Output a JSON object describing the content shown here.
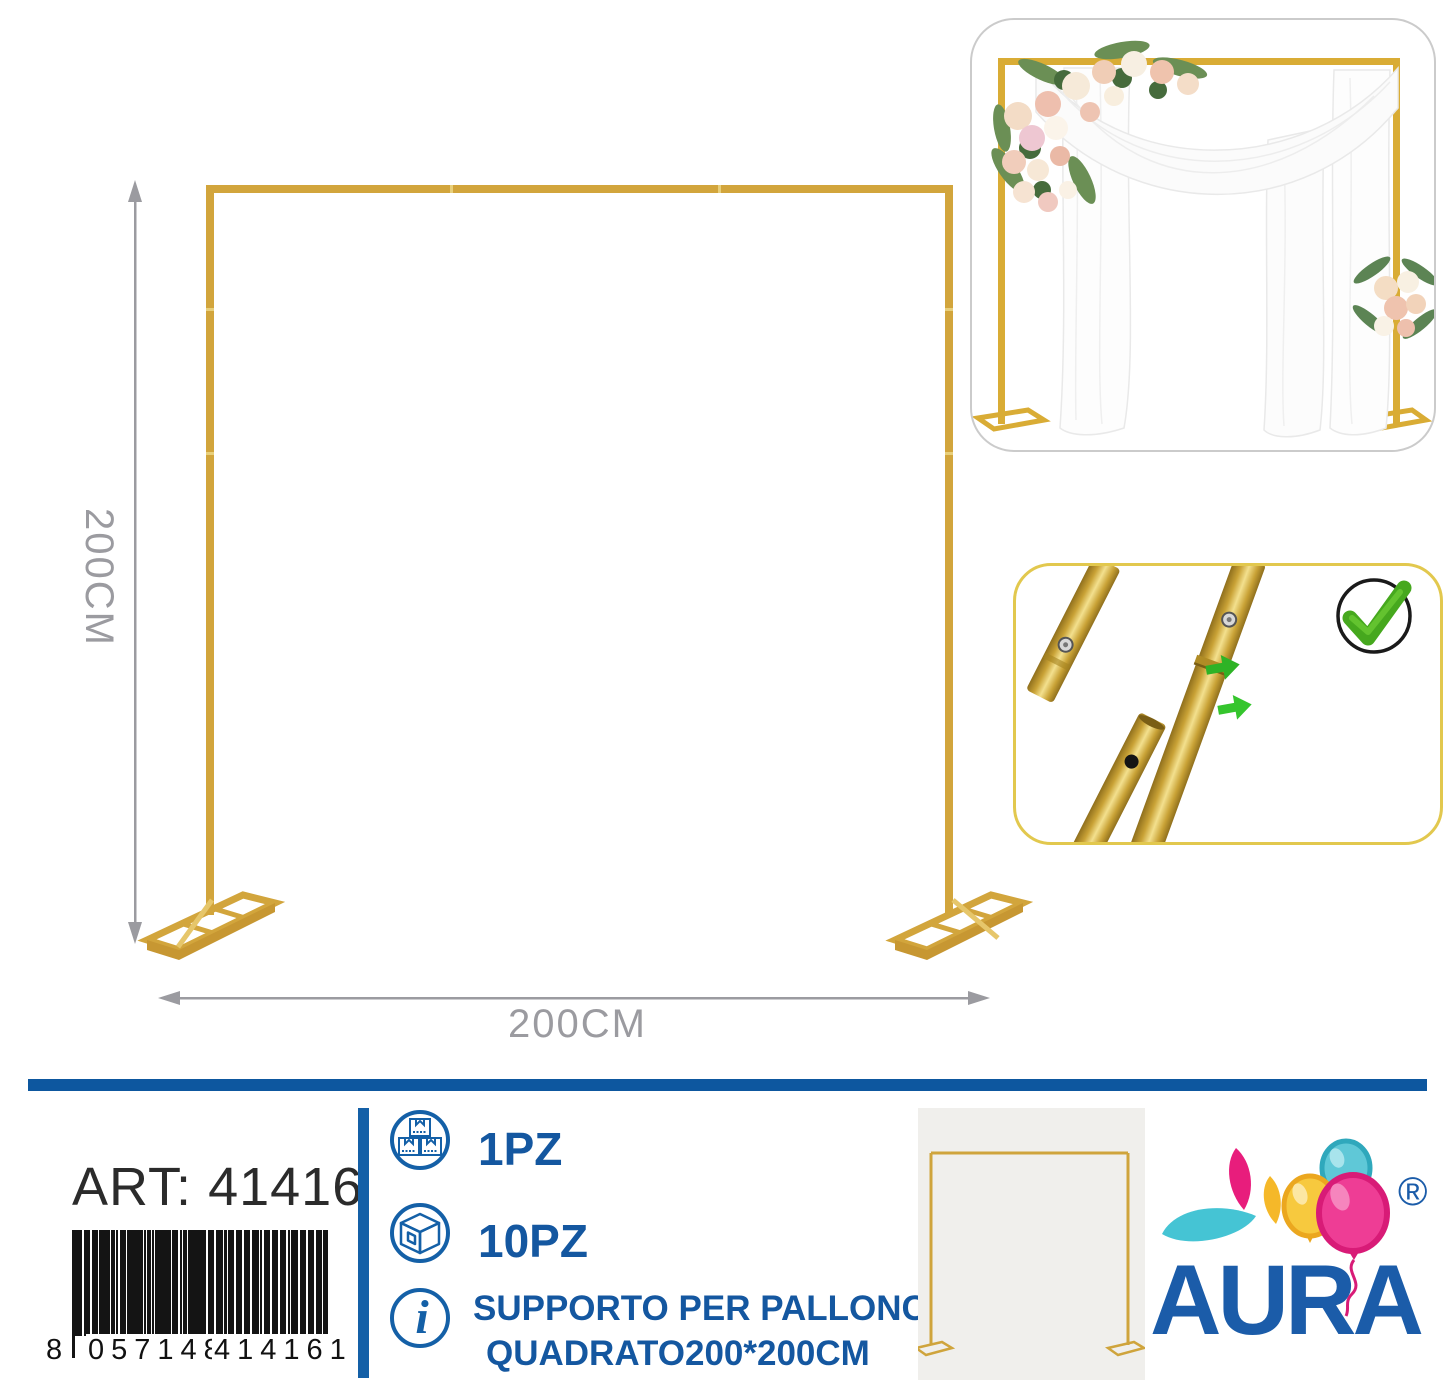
{
  "colors": {
    "gold": "#d2a53c",
    "gold_dark": "#c29334",
    "arrow_gray": "#9b9ba0",
    "blue": "#1460a7",
    "bar_blue": "#0d579f",
    "text_dark": "#2b2b2b",
    "green": "#3cb01f",
    "brand_blue": "#1b5ca9",
    "balloon_teal": "#5fc8d7",
    "balloon_yellow": "#f7c93e",
    "balloon_pink": "#ee3d95"
  },
  "diagram": {
    "height_label": "200CM",
    "width_label": "200CM"
  },
  "insets": {
    "photo": "decorated gold backdrop stand with white drapes and flowers",
    "detail": "telescopic pole connection with push-button, approved"
  },
  "info": {
    "art_label": "ART:",
    "art_value": "41416",
    "barcode_lead": "8",
    "barcode_group1": "057148",
    "barcode_group2": "414161",
    "rows": [
      {
        "icon": "stacked-boxes-icon",
        "label": "1PZ"
      },
      {
        "icon": "carton-box-icon",
        "label": "10PZ"
      },
      {
        "icon": "info-icon",
        "line1": "SUPPORTO PER PALLONCINI",
        "line2": "QUADRATO200*200CM"
      }
    ],
    "brand_name": "AURA",
    "registered_mark": "®"
  }
}
